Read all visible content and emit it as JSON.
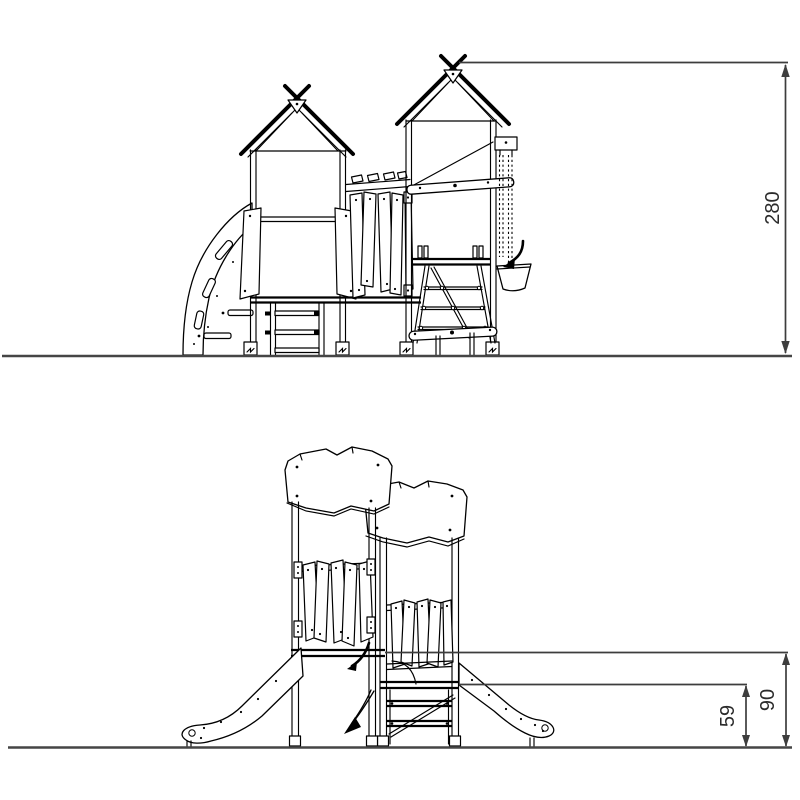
{
  "page": {
    "background": "#ffffff"
  },
  "colors": {
    "line": "#000000",
    "ground_line": "#454545",
    "dimension_line": "#3d3d3d",
    "dimension_text": "#2b2b2b"
  },
  "dimensions": {
    "overall_height": "280",
    "upper_platform_height": "90",
    "lower_platform_height": "59"
  }
}
